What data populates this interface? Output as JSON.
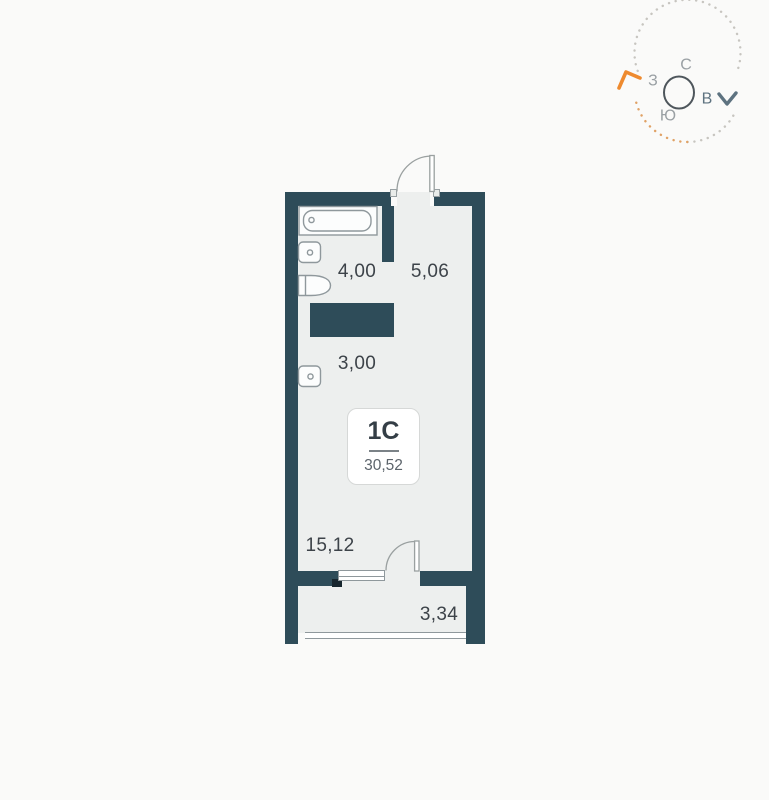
{
  "palette": {
    "wall": "#2e4c59",
    "floor": "#edefee",
    "background": "#fafaf9",
    "accent_orange": "#ee8a2f",
    "accent_blue": "#5d7280"
  },
  "compass": {
    "north": "С",
    "west": "З",
    "east": "В",
    "south": "Ю"
  },
  "unit": {
    "label": "1С",
    "total_area": "30,52"
  },
  "rooms": [
    {
      "name": "bathroom",
      "area": "4,00"
    },
    {
      "name": "hallway",
      "area": "5,06"
    },
    {
      "name": "kitchen-niche",
      "area": "3,00"
    },
    {
      "name": "living-room",
      "area": "15,12"
    },
    {
      "name": "balcony",
      "area": "3,34"
    }
  ]
}
